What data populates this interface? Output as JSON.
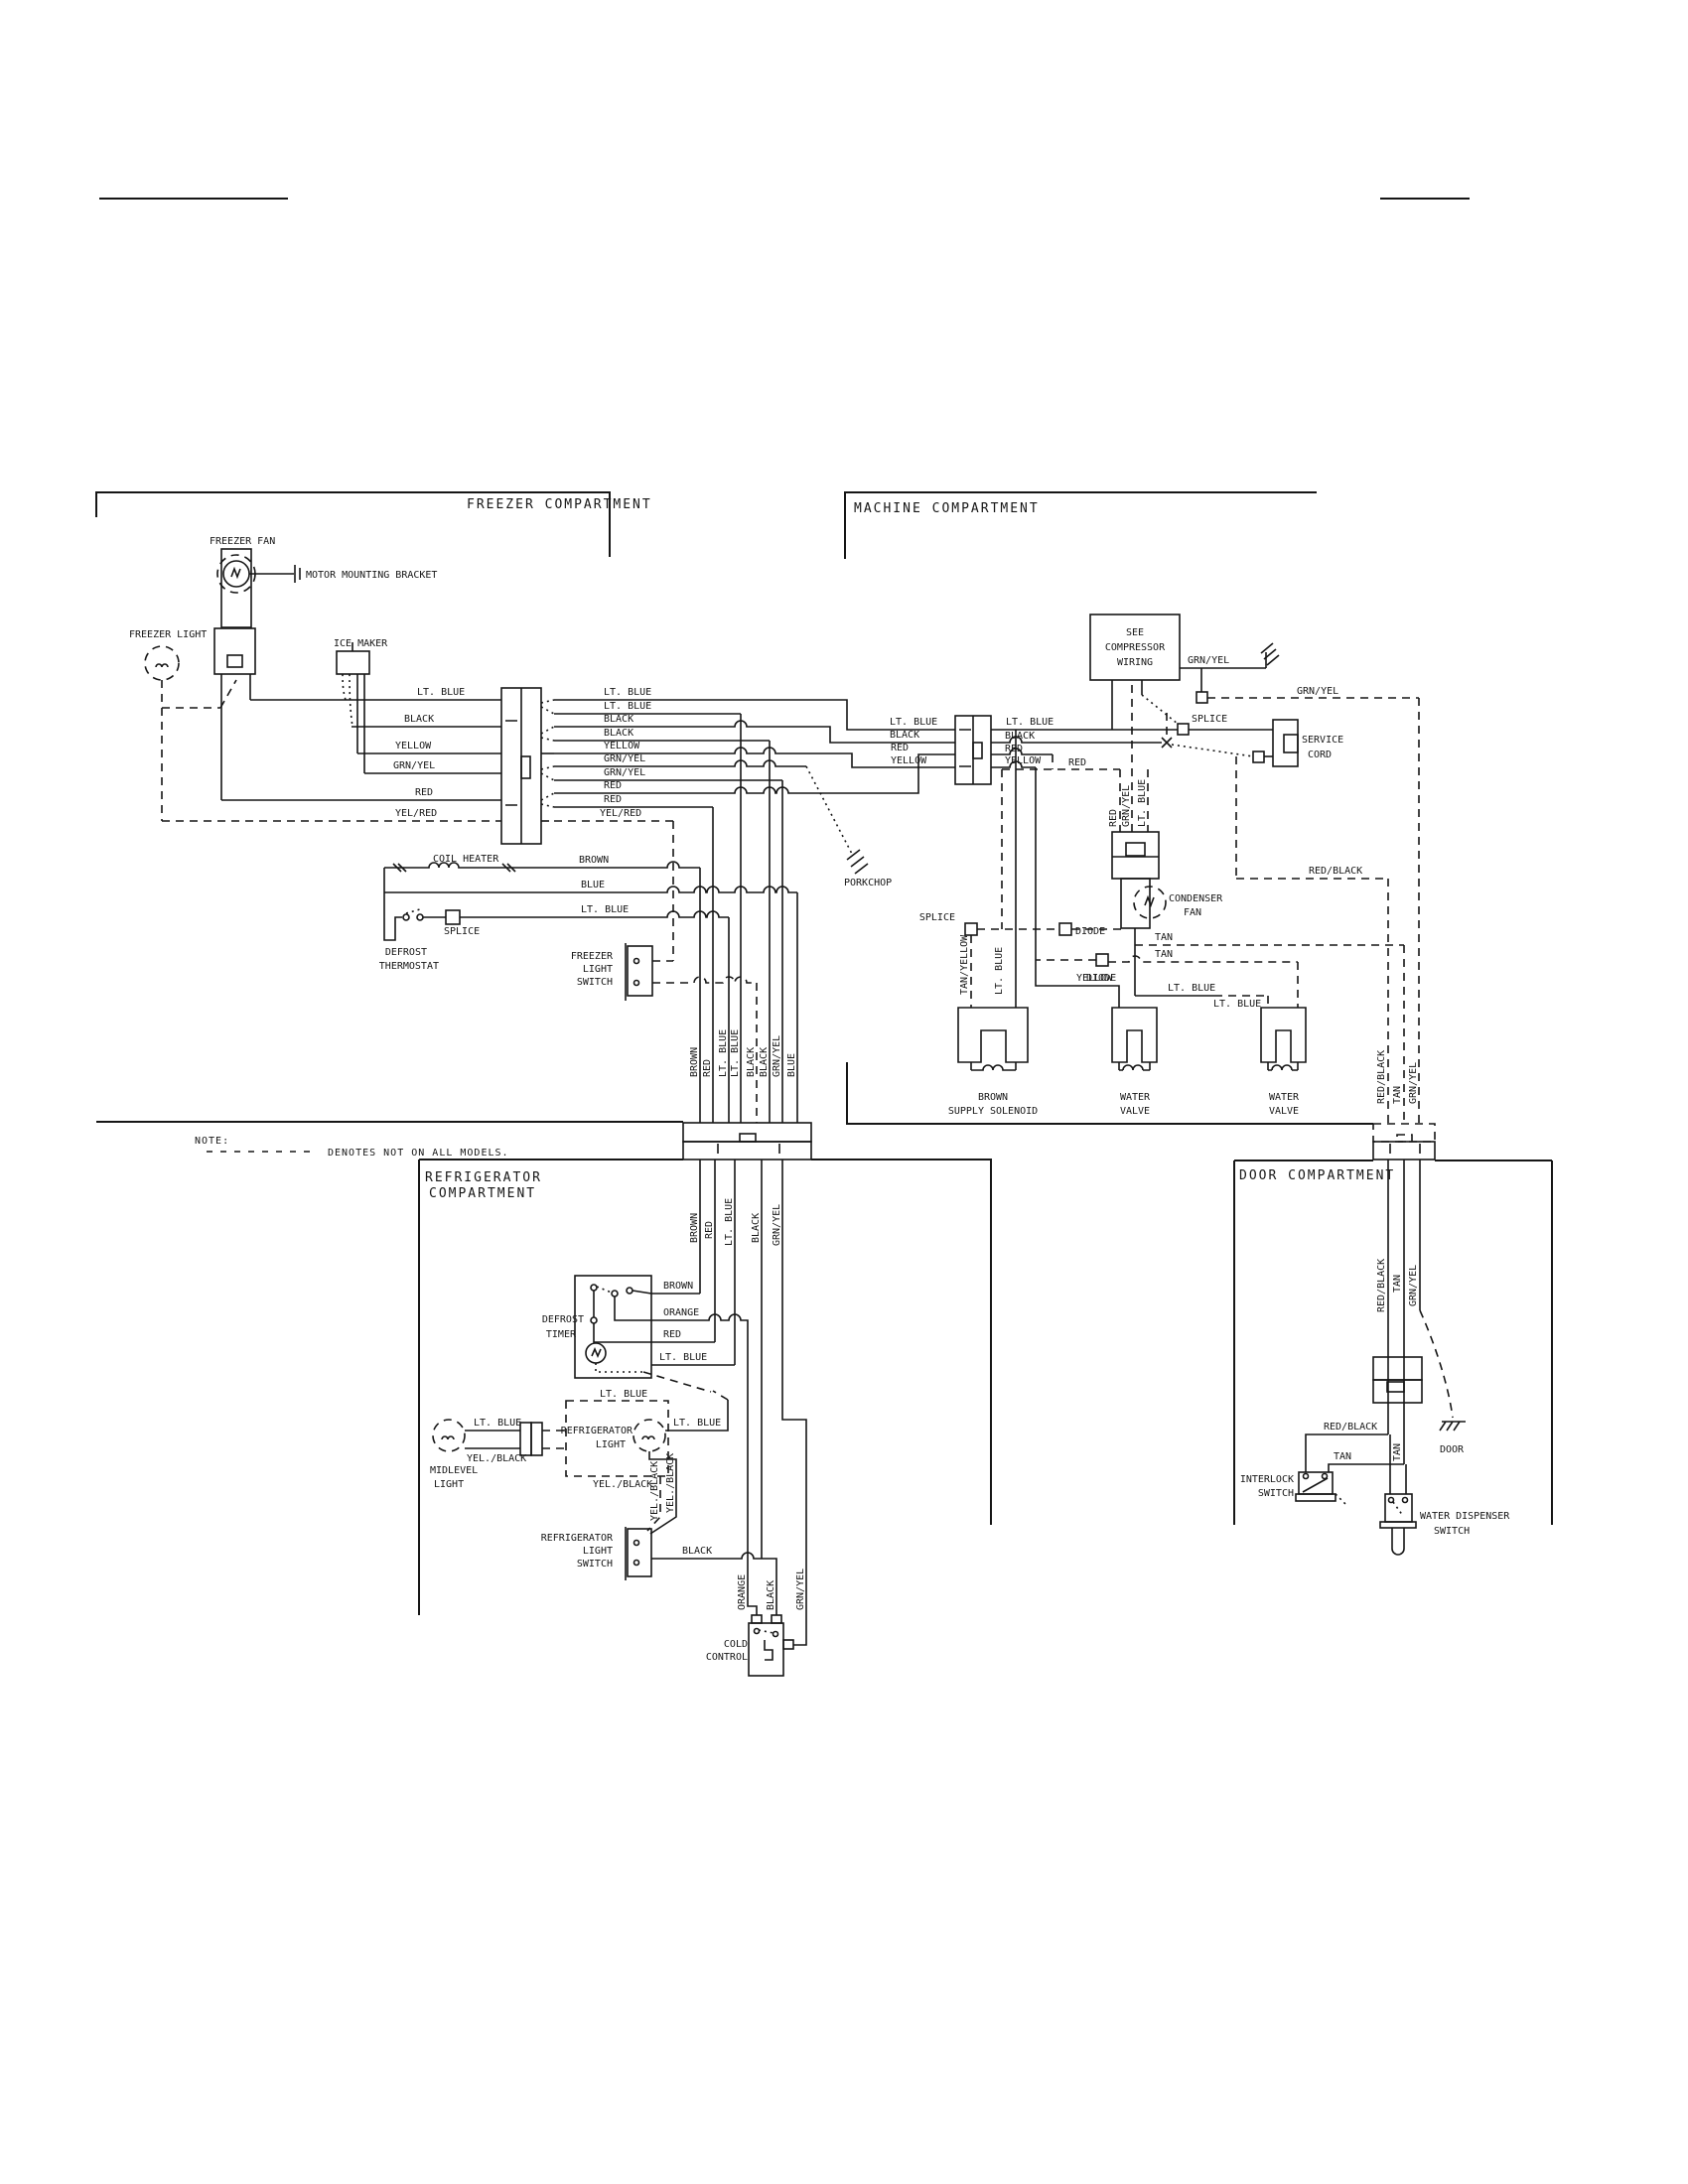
{
  "note": {
    "label": "NOTE:",
    "legend": "DENOTES NOT ON ALL MODELS."
  },
  "compartments": {
    "freezer": "FREEZER COMPARTMENT",
    "machine": "MACHINE COMPARTMENT",
    "refrigerator_l1": "REFRIGERATOR",
    "refrigerator_l2": "COMPARTMENT",
    "door": "DOOR COMPARTMENT"
  },
  "wires": {
    "lt_blue": "LT. BLUE",
    "black": "BLACK",
    "yellow": "YELLOW",
    "grn_yel": "GRN/YEL",
    "red": "RED",
    "yel_red": "YEL/RED",
    "brown": "BROWN",
    "blue": "BLUE",
    "orange": "ORANGE",
    "yel_black": "YEL./BLACK",
    "red_black": "RED/BLACK",
    "tan": "TAN",
    "tan_yellow": "TAN/YELLOW"
  },
  "components": {
    "freezer_fan": "FREEZER FAN",
    "motor_bracket": "MOTOR MOUNTING BRACKET",
    "freezer_light": "FREEZER LIGHT",
    "ice_maker": "ICE MAKER",
    "coil_heater": "COIL HEATER",
    "splice": "SPLICE",
    "porkchop": "PORKCHOP",
    "diode": "DIODE",
    "door": "DOOR",
    "defrost_thermostat": {
      "l1": "DEFROST",
      "l2": "THERMOSTAT"
    },
    "freezer_light_switch": {
      "l1": "FREEZER",
      "l2": "LIGHT",
      "l3": "SWITCH"
    },
    "compressor": {
      "l1": "SEE",
      "l2": "COMPRESSOR",
      "l3": "WIRING"
    },
    "service_cord": {
      "l1": "SERVICE",
      "l2": "CORD"
    },
    "condenser_fan": {
      "l1": "CONDENSER",
      "l2": "FAN"
    },
    "supply_solenoid": {
      "l1": "BROWN",
      "l2": "SUPPLY SOLENOID"
    },
    "water_valve": {
      "l1": "WATER",
      "l2": "VALVE"
    },
    "defrost_timer": {
      "l1": "DEFROST",
      "l2": "TIMER"
    },
    "midlevel_light": {
      "l1": "MIDLEVEL",
      "l2": "LIGHT"
    },
    "refrigerator_light": {
      "l1": "REFRIGERATOR",
      "l2": "LIGHT"
    },
    "refrigerator_light_switch": {
      "l1": "REFRIGERATOR",
      "l2": "LIGHT",
      "l3": "SWITCH"
    },
    "cold_control": {
      "l1": "COLD",
      "l2": "CONTROL"
    },
    "interlock_switch": {
      "l1": "INTERLOCK",
      "l2": "SWITCH"
    },
    "water_dispenser_switch": {
      "l1": "WATER DISPENSER",
      "l2": "SWITCH"
    }
  }
}
